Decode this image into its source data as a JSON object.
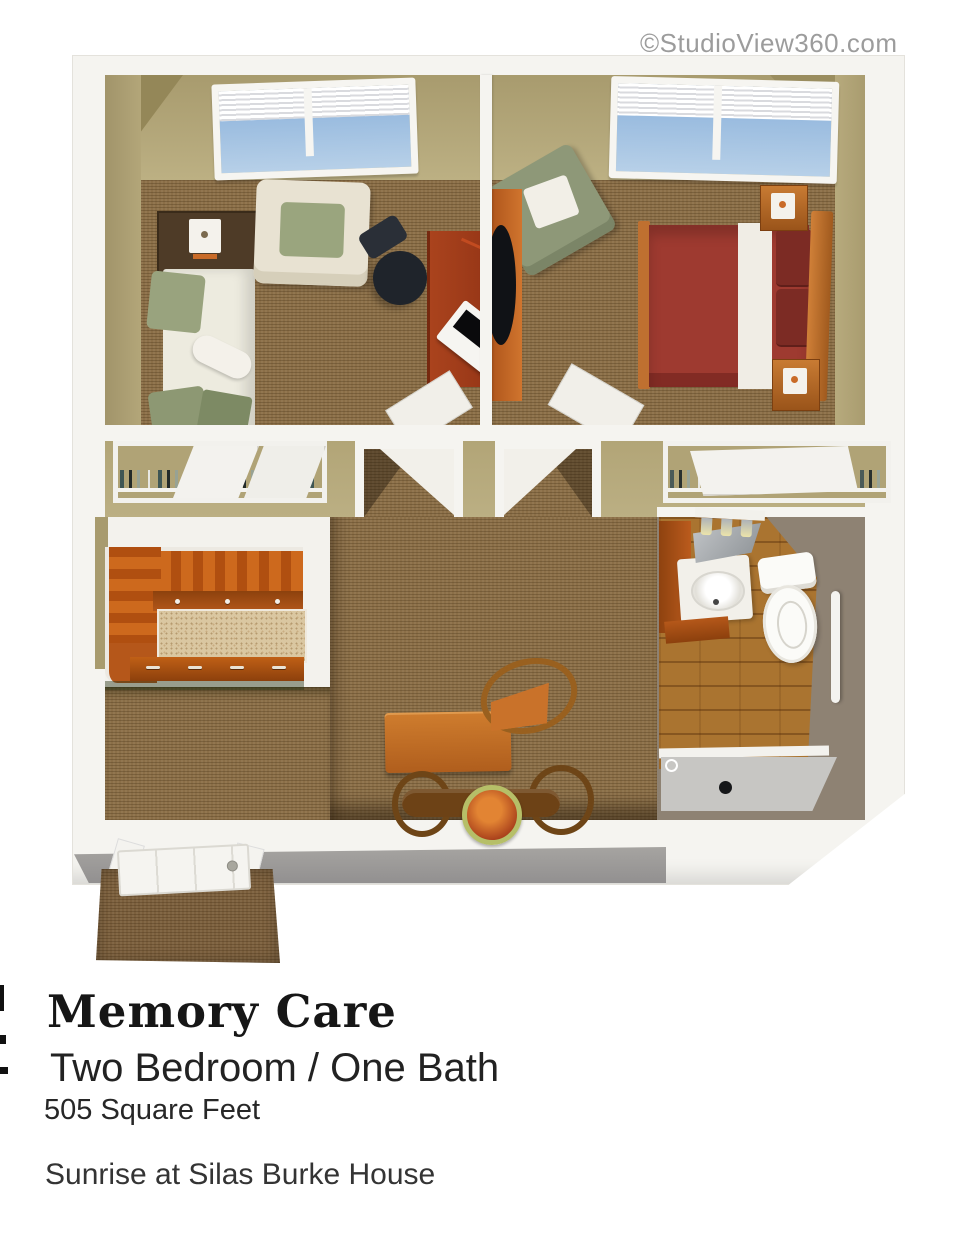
{
  "watermark": "©StudioView360.com",
  "caption": {
    "title": "Memory Care",
    "subtitle": "Two Bedroom / One Bath",
    "area": "505 Square Feet",
    "facility": "Sunrise at Silas Burke House"
  },
  "colors": {
    "carpet": "#8b6f48",
    "wall-tan": "#b7aa7d",
    "wall-tan-dark": "#97895b",
    "wall-white": "#f5f4f0",
    "front-gray": "#9d9b98",
    "cabinet": "#c3601a",
    "cabinet-dark": "#8e420f",
    "counter": "#dac7a1",
    "bed-red": "#9e3a30",
    "bed-red-dark": "#7c2b24",
    "wood-frame": "#c07030",
    "sage": "#97a07c",
    "cream": "#e8e2d2",
    "desk-wood": "#9d3c1b",
    "bath-wall": "#8e8273",
    "bath-floor": "#aa7430",
    "shower": "#c7c6c3",
    "mat": "#7b5f3d",
    "win-blue-a": "#89b0da",
    "win-blue-b": "#b7d0e8",
    "wm": "#9c9c9c",
    "ink": "#161616"
  }
}
